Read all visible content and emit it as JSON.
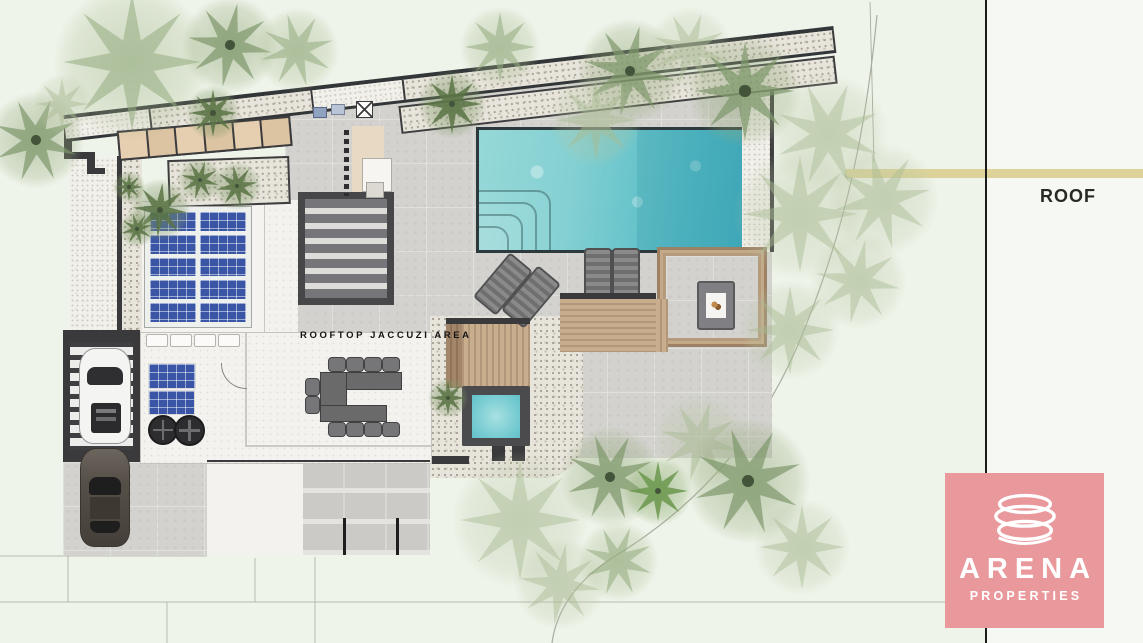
{
  "labels": {
    "jacuzzi_area": "ROOFTOP JACCUZI AREA",
    "roof": "ROOF"
  },
  "logo": {
    "brand": "ARENA",
    "tagline": "PROPERTIES",
    "background": "#e9989c",
    "text_color": "#ffffff",
    "icon": "stacked-rings-icon"
  },
  "colors": {
    "background": "#eff4ea",
    "pool_water": "#5ec1ca",
    "jacuzzi_water": "#7ecfd4",
    "gold_band": "#ddd39a",
    "parapet_wall": "#3a3a3c",
    "wood_deck": "#c3a987",
    "solar_panel": "#3a55a5",
    "boundary_line": "#1b1b1b"
  },
  "plan_elements": [
    "swimming-pool",
    "pool-corner-steps",
    "sun-loungers",
    "wood-deck",
    "pergola",
    "fire-pit",
    "jacuzzi",
    "jacuzzi-wood-deck",
    "solar-panel-array",
    "small-solar-panels",
    "ac-fan-units",
    "u-shaped-dining-table",
    "dining-chairs",
    "stairwell",
    "slatted-pergola-roof",
    "carport",
    "white-car",
    "dark-car",
    "driveway",
    "paved-terrace",
    "gravel-beds",
    "palm-trees",
    "roof-parapet",
    "skylight-row",
    "property-boundary"
  ]
}
